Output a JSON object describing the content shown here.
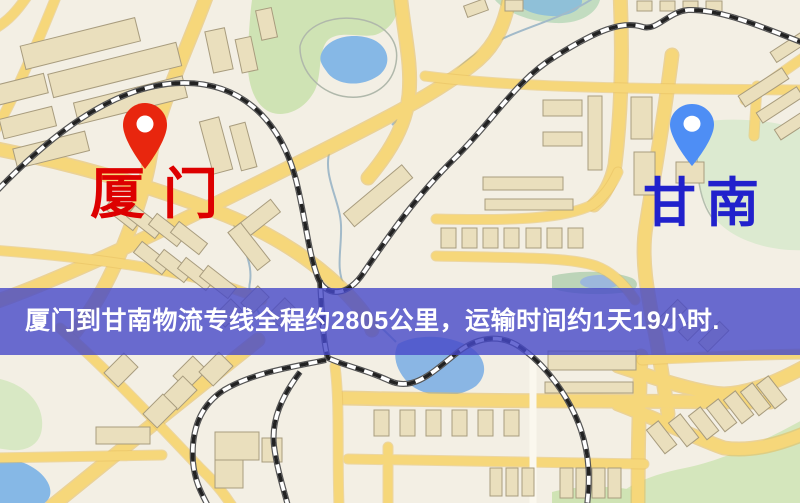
{
  "banner": {
    "text": "厦门到甘南物流专线全程约2805公里，运输时间约1天19小时.",
    "background_color": "rgba(70,72,200,0.8)",
    "text_color": "#ffffff"
  },
  "markers": {
    "origin": {
      "label": "厦门",
      "label_color": "#dd0000",
      "pin_color": "#e8260e",
      "pin_style": "red-map-pin"
    },
    "destination": {
      "label": "甘南",
      "label_color": "#2121cc",
      "pin_color": "#4e8ef5",
      "pin_style": "blue-map-pin"
    }
  },
  "map_palette": {
    "background": "#f3efe4",
    "road_fill": "#f6d77a",
    "road_casing": "#e3b955",
    "building_fill": "#eadfbd",
    "building_stroke": "#a89c7e",
    "park_green": "#cfe3b4",
    "water_blue": "#86b8e6",
    "railway_dark": "#2e2e2e"
  }
}
